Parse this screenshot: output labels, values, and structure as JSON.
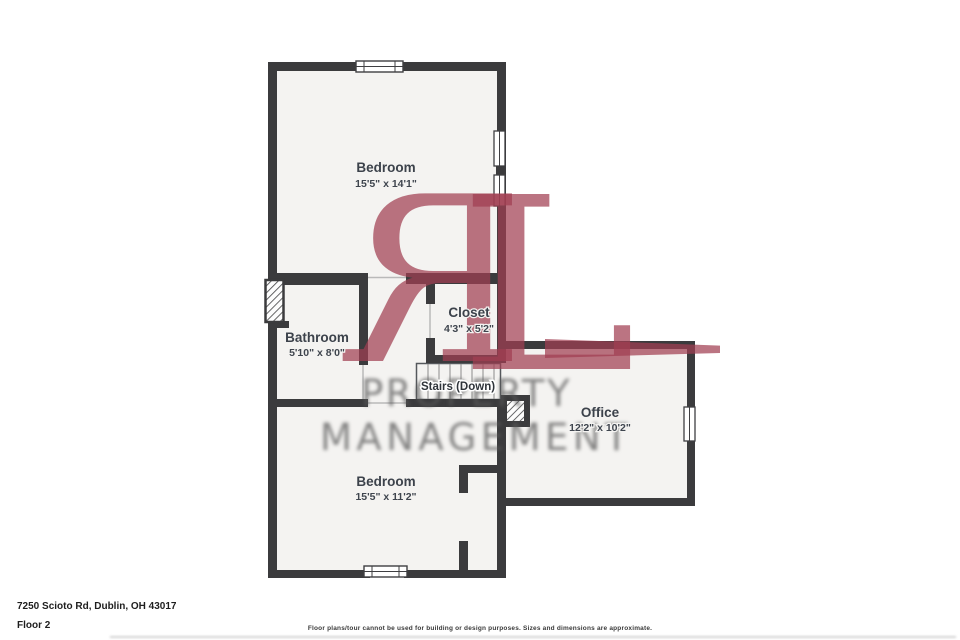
{
  "floorplan": {
    "rooms": {
      "bedroom_top": {
        "name": "Bedroom",
        "dims": "15'5\" x 14'1\""
      },
      "bathroom": {
        "name": "Bathroom",
        "dims": "5'10\" x 8'0\""
      },
      "closet": {
        "name": "Closet",
        "dims": "4'3\" x 5'2\""
      },
      "stairs": {
        "name": "Stairs (Down)"
      },
      "office": {
        "name": "Office",
        "dims": "12'2\" x 10'2\""
      },
      "bedroom_bottom": {
        "name": "Bedroom",
        "dims": "15'5\" x 11'2\""
      }
    },
    "colors": {
      "wall": "#3b3b3d",
      "room_fill": "#f4f3f1",
      "label": "#3c424b"
    }
  },
  "watermark": {
    "monogram_r": "R",
    "monogram_l": "L",
    "line1": "PROPERTY",
    "line2": "MANAGEMENT",
    "accent_color": "#a13e52",
    "text_color": "#585858"
  },
  "footer": {
    "address": "7250 Scioto Rd, Dublin, OH 43017",
    "floor_label": "Floor 2",
    "disclaimer": "Floor plans/tour cannot be used for building or design purposes. Sizes and dimensions are approximate."
  }
}
